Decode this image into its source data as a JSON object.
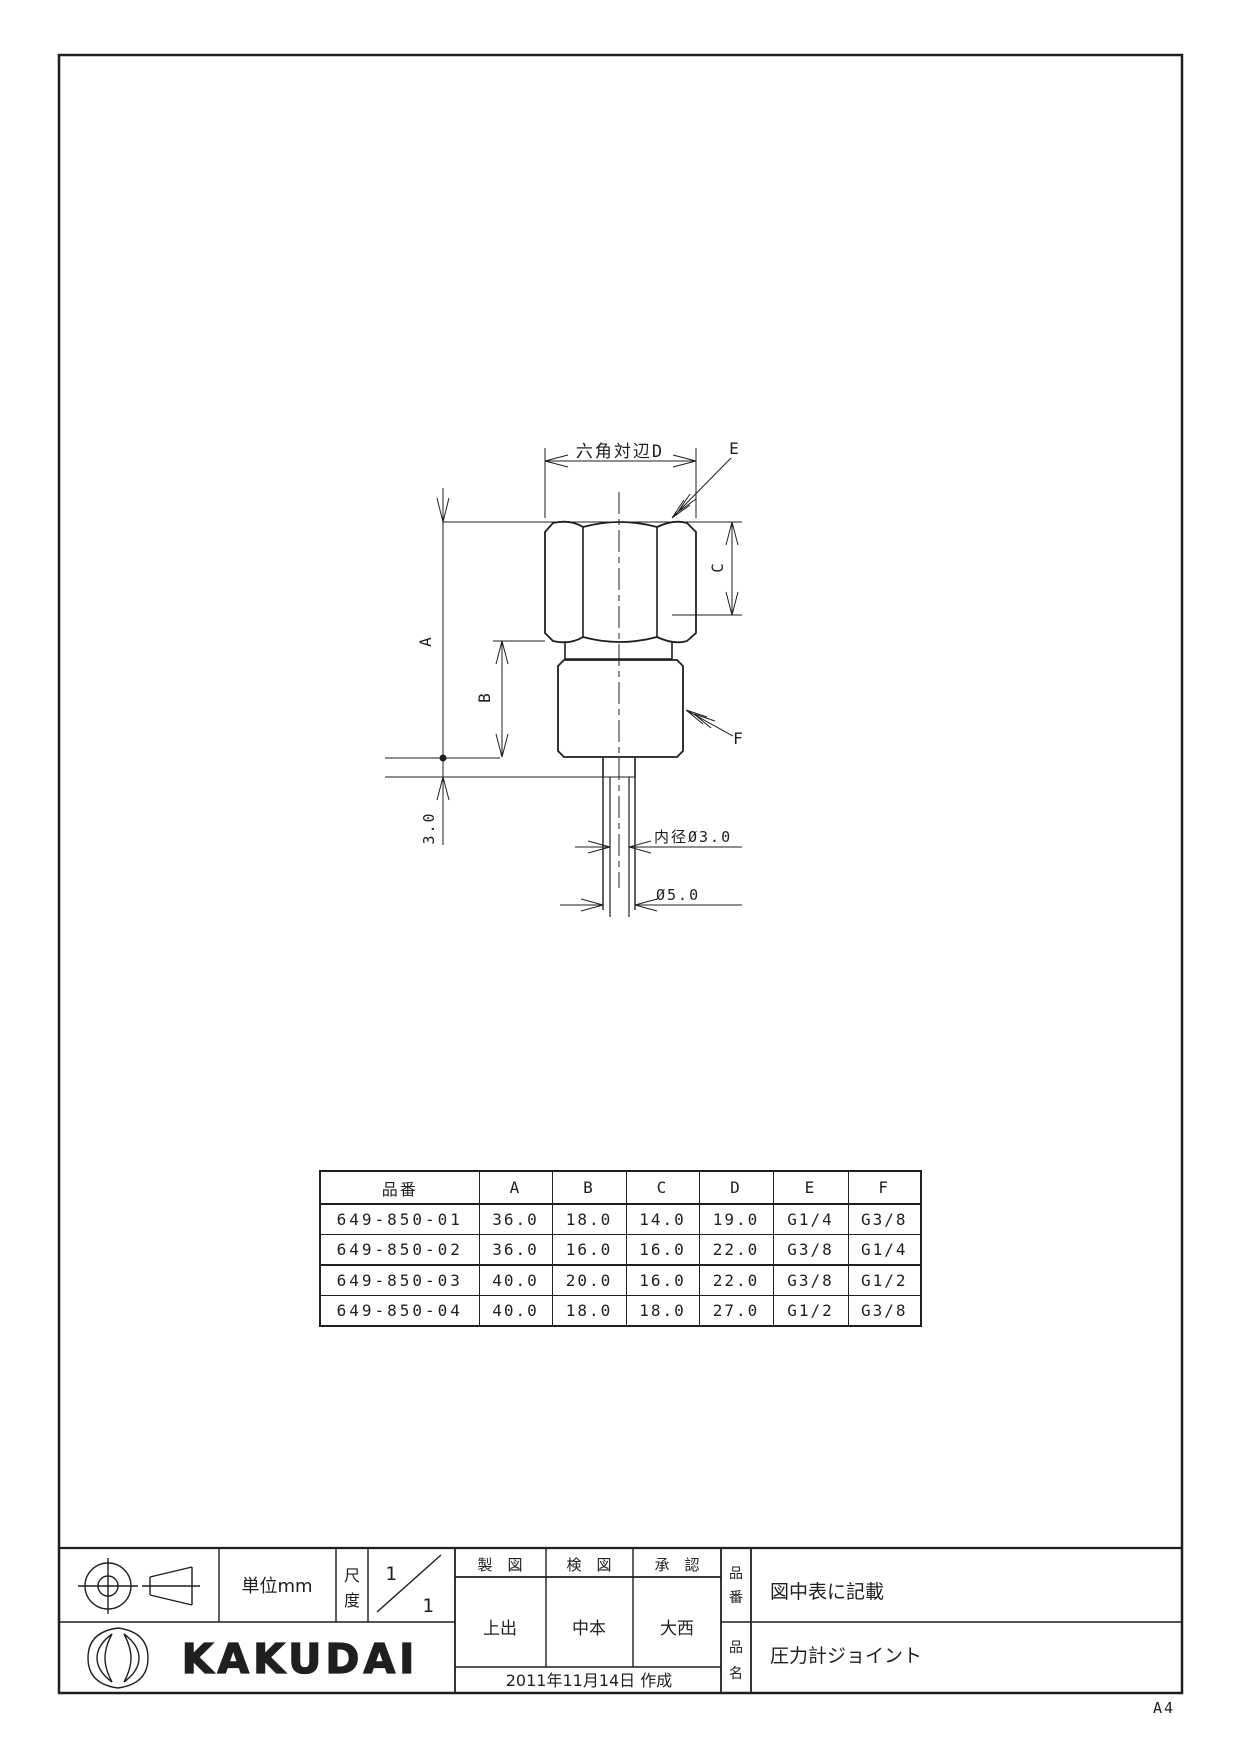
{
  "drawing": {
    "labels": {
      "width_across_flats": "六角対辺D",
      "dim_a": "A",
      "dim_b": "B",
      "dim_c": "C",
      "dim_e": "E",
      "dim_f": "F",
      "dim_3": "3.0",
      "inner_dia": "内径Ø3.0",
      "outer_dia": "Ø5.0"
    },
    "line_color": "#1f1f1f"
  },
  "table": {
    "headers": [
      "品番",
      "A",
      "B",
      "C",
      "D",
      "E",
      "F"
    ],
    "rows": [
      [
        "649-850-01",
        "36.0",
        "18.0",
        "14.0",
        "19.0",
        "G1/4",
        "G3/8"
      ],
      [
        "649-850-02",
        "36.0",
        "16.0",
        "16.0",
        "22.0",
        "G3/8",
        "G1/4"
      ],
      [
        "649-850-03",
        "40.0",
        "20.0",
        "16.0",
        "22.0",
        "G3/8",
        "G1/2"
      ],
      [
        "649-850-04",
        "40.0",
        "18.0",
        "18.0",
        "27.0",
        "G1/2",
        "G3/8"
      ]
    ]
  },
  "titleblock": {
    "unit_label": "単位mm",
    "scale": {
      "label_top": "尺",
      "label_bottom": "度",
      "numerator": "1",
      "denominator": "1"
    },
    "sig": {
      "draft_header": "製　図",
      "check_header": "検　図",
      "approve_header": "承　認",
      "drafter": "上出",
      "checker": "中本",
      "approver": "大西",
      "date": "2011年11月14日 作成"
    },
    "part_no": {
      "label_top": "品",
      "label_bottom": "番",
      "value": "図中表に記載"
    },
    "part_name": {
      "label_top": "品",
      "label_bottom": "名",
      "value": "圧力計ジョイント"
    },
    "company_logo": "KAKUDAI",
    "paper_size": "A4"
  }
}
